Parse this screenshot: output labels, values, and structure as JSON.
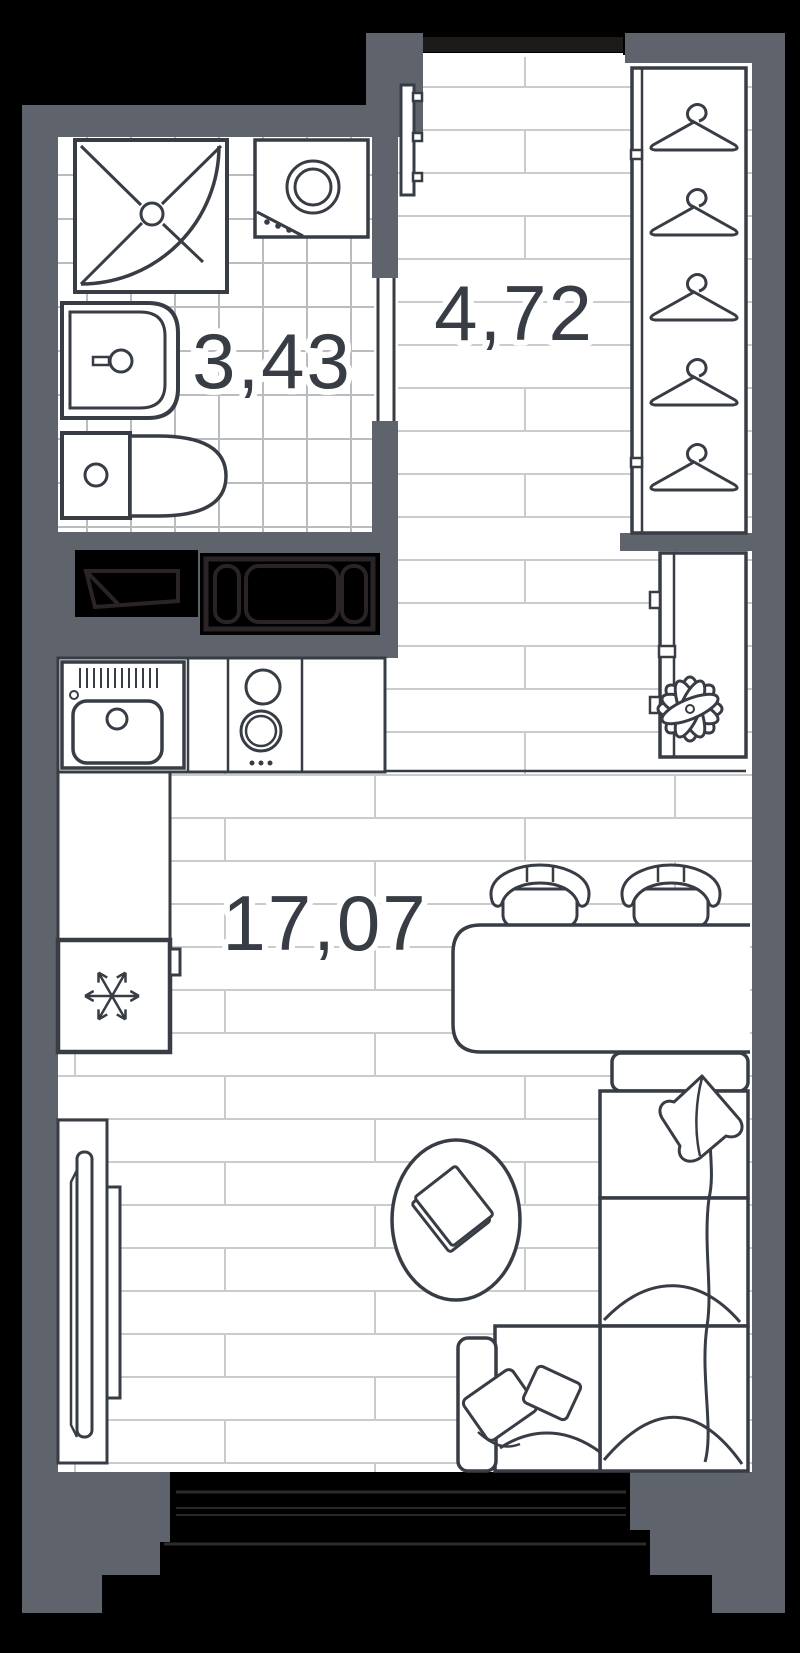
{
  "title": "Studio apartment floor plan",
  "rooms": [
    {
      "name": "bathroom",
      "area": "3,43"
    },
    {
      "name": "hallway",
      "area": "4,72"
    },
    {
      "name": "living-kitchen",
      "area": "17,07"
    }
  ],
  "colors": {
    "background": "#000000",
    "wall": "#5f646c",
    "outline": "#373c45",
    "plank_line": "#c9cbcd",
    "tile_line": "#babdc0",
    "shaft_line": "#2a2426",
    "entry_door": "#1d1b1a",
    "window_line": "#2e2b2b"
  },
  "icons": {
    "hanger": "triangle-with-hook",
    "snowflake": "six-spoke-star",
    "plant": "eight-petal-flower",
    "shower": "quarter-circle-tray-with-cross",
    "stove": "two-burners",
    "kitchen-sink": "basin-with-drainer"
  }
}
